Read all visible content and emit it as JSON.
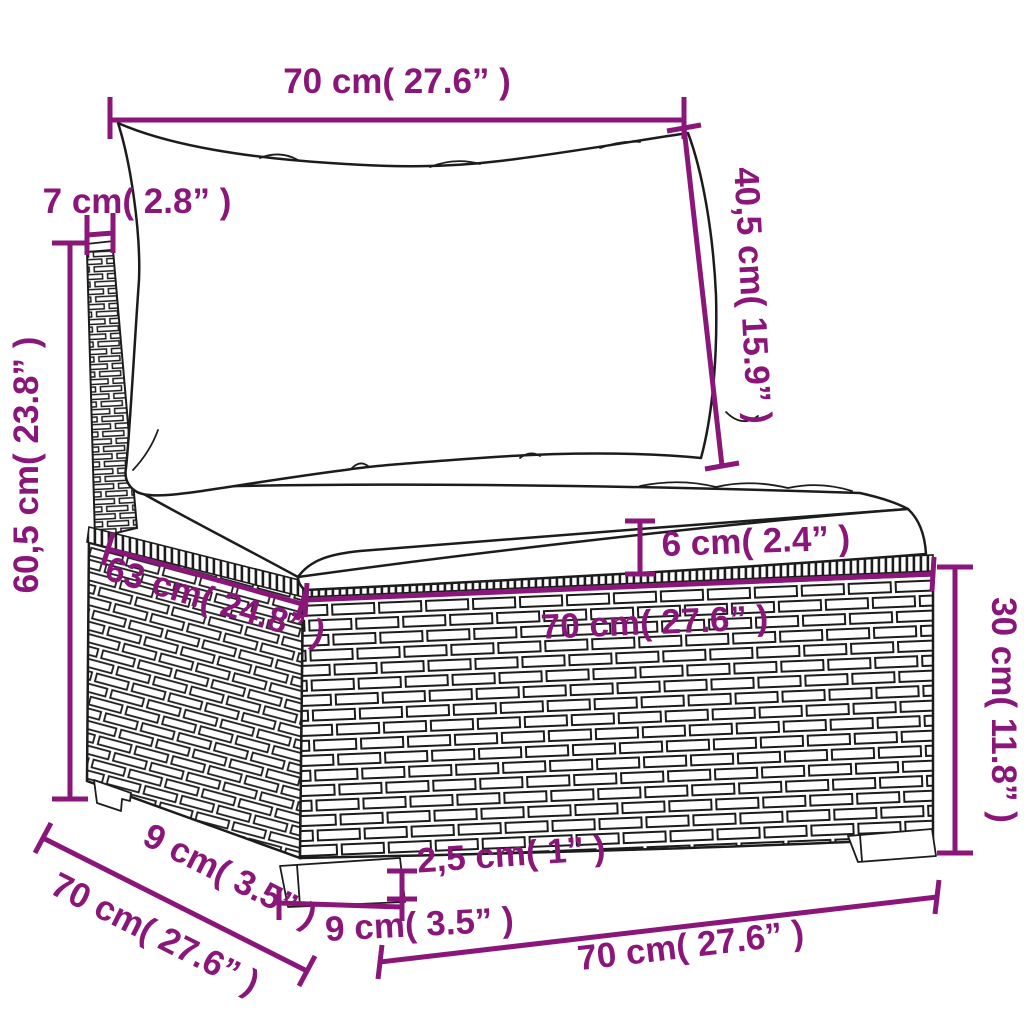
{
  "diagram": {
    "kind": "product-dimension-diagram",
    "subject": "poly-rattan garden sofa middle section with cushions",
    "accent_color": "#8a1679",
    "outline_color": "#1c1c1c",
    "background_color": "#ffffff"
  },
  "dimensions": {
    "back_cushion_width": "70 cm( 27.6” )",
    "back_cushion_height": "40,5 cm( 15.9” )",
    "back_depth": "7 cm( 2.8” )",
    "total_height": "60,5 cm( 23.8” )",
    "seat_cushion_thickness": "6 cm( 2.4” )",
    "seat_depth": "63 cm( 24.8” )",
    "base_width": "70 cm( 27.6” )",
    "base_height": "30 cm( 11.8” )",
    "leg_height": "2,5 cm( 1” )",
    "front_leg_width": "9 cm( 3.5” )",
    "total_width": "70 cm( 27.6” )",
    "side_leg_depth": "9 cm( 3.5” )",
    "total_depth": "70 cm( 27.6” )"
  }
}
